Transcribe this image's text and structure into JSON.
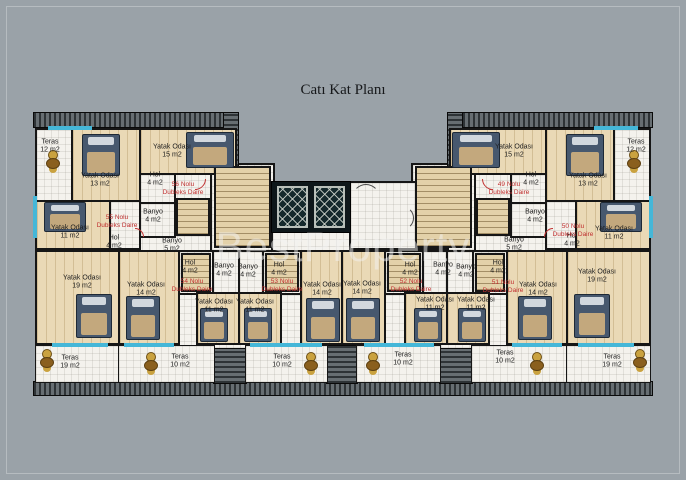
{
  "title": "Catı Kat Planı",
  "watermark": "BestProperty",
  "colors": {
    "background": "#9aa2a8",
    "walls": "#161616",
    "window_accent": "#45b7d8",
    "apartment_label": "#c03030",
    "wood_floor": "#ead9b6",
    "tile_floor": "#f4f2ed",
    "roof_edge": "#2e3336"
  },
  "plan": {
    "labels": [
      {
        "text": "Teras\n12 m2",
        "x": 50,
        "y": 147,
        "type": "room"
      },
      {
        "text": "Yatak Odası\n13 m2",
        "x": 100,
        "y": 181,
        "type": "room"
      },
      {
        "text": "Yatak Odası\n15 m2",
        "x": 172,
        "y": 152,
        "type": "room"
      },
      {
        "text": "Hol\n4 m2",
        "x": 155,
        "y": 180,
        "type": "room"
      },
      {
        "text": "Banyo\n4 m2",
        "x": 153,
        "y": 217,
        "type": "room"
      },
      {
        "text": "Yatak Odası\n11 m2",
        "x": 70,
        "y": 233,
        "type": "room"
      },
      {
        "text": "Hol\n4 m2",
        "x": 114,
        "y": 243,
        "type": "room"
      },
      {
        "text": "Banyo\n5 m2",
        "x": 172,
        "y": 246,
        "type": "room"
      },
      {
        "text": "Yatak Odası\n19 m2",
        "x": 82,
        "y": 283,
        "type": "room"
      },
      {
        "text": "Hol\n4 m2",
        "x": 190,
        "y": 268,
        "type": "room"
      },
      {
        "text": "Yatak Odası\n14 m2",
        "x": 146,
        "y": 290,
        "type": "room"
      },
      {
        "text": "Banyo\n4 m2",
        "x": 224,
        "y": 271,
        "type": "room"
      },
      {
        "text": "Banyo\n4 m2",
        "x": 248,
        "y": 272,
        "type": "room"
      },
      {
        "text": "Yatak Odası\n11 m2",
        "x": 214,
        "y": 307,
        "type": "room"
      },
      {
        "text": "Yatak Odası\n11 m2",
        "x": 255,
        "y": 307,
        "type": "room"
      },
      {
        "text": "Hol\n4 m2",
        "x": 279,
        "y": 270,
        "type": "room"
      },
      {
        "text": "Yatak Odası\n14 m2",
        "x": 322,
        "y": 290,
        "type": "room"
      },
      {
        "text": "Teras\n19 m2",
        "x": 70,
        "y": 363,
        "type": "room"
      },
      {
        "text": "Teras\n10 m2",
        "x": 180,
        "y": 362,
        "type": "room"
      },
      {
        "text": "Teras\n10 m2",
        "x": 282,
        "y": 362,
        "type": "room"
      },
      {
        "text": "Hol\n4 m2",
        "x": 410,
        "y": 270,
        "type": "room"
      },
      {
        "text": "Yatak Odası\n14 m2",
        "x": 362,
        "y": 289,
        "type": "room"
      },
      {
        "text": "Banyo\n4 m2",
        "x": 443,
        "y": 270,
        "type": "room"
      },
      {
        "text": "Banyo\n4 m2",
        "x": 466,
        "y": 272,
        "type": "room"
      },
      {
        "text": "Yatak Odası\n11 m2",
        "x": 435,
        "y": 305,
        "type": "room"
      },
      {
        "text": "Yatak Odası\n11 m2",
        "x": 476,
        "y": 305,
        "type": "room"
      },
      {
        "text": "Hol\n4 m2",
        "x": 498,
        "y": 268,
        "type": "room"
      },
      {
        "text": "Yatak Odası\n14 m2",
        "x": 538,
        "y": 290,
        "type": "room"
      },
      {
        "text": "Yatak Odası\n19 m2",
        "x": 597,
        "y": 277,
        "type": "room"
      },
      {
        "text": "Teras\n10 m2",
        "x": 403,
        "y": 360,
        "type": "room"
      },
      {
        "text": "Teras\n10 m2",
        "x": 505,
        "y": 358,
        "type": "room"
      },
      {
        "text": "Teras\n19 m2",
        "x": 612,
        "y": 362,
        "type": "room"
      },
      {
        "text": "Banyo\n5 m2",
        "x": 514,
        "y": 245,
        "type": "room"
      },
      {
        "text": "Hol\n4 m2",
        "x": 572,
        "y": 241,
        "type": "room"
      },
      {
        "text": "Yatak Odası\n11 m2",
        "x": 614,
        "y": 234,
        "type": "room"
      },
      {
        "text": "Banyo\n4 m2",
        "x": 535,
        "y": 217,
        "type": "room"
      },
      {
        "text": "Hol\n4 m2",
        "x": 531,
        "y": 180,
        "type": "room"
      },
      {
        "text": "Yatak Odası\n13 m2",
        "x": 588,
        "y": 181,
        "type": "room"
      },
      {
        "text": "Yatak Odası\n15 m2",
        "x": 514,
        "y": 152,
        "type": "room"
      },
      {
        "text": "Teras\n12 m2",
        "x": 636,
        "y": 147,
        "type": "room"
      },
      {
        "text": "56 Nolu\nDubleks Daire",
        "x": 183,
        "y": 189,
        "type": "apartment"
      },
      {
        "text": "55 Nolu\nDubleks Daire",
        "x": 117,
        "y": 222,
        "type": "apartment"
      },
      {
        "text": "54 Nolu\nDubleks Daire",
        "x": 192,
        "y": 286,
        "type": "apartment"
      },
      {
        "text": "53 Nolu\nDubleks Daire",
        "x": 282,
        "y": 286,
        "type": "apartment"
      },
      {
        "text": "52 Nolu\nDubleks Daire",
        "x": 411,
        "y": 286,
        "type": "apartment"
      },
      {
        "text": "51 Nolu\nDubleks Daire",
        "x": 503,
        "y": 287,
        "type": "apartment"
      },
      {
        "text": "50 Nolu\nDubleks Daire",
        "x": 573,
        "y": 231,
        "type": "apartment"
      },
      {
        "text": "49 Nolu\nDubleks Daire",
        "x": 509,
        "y": 189,
        "type": "apartment"
      }
    ]
  }
}
